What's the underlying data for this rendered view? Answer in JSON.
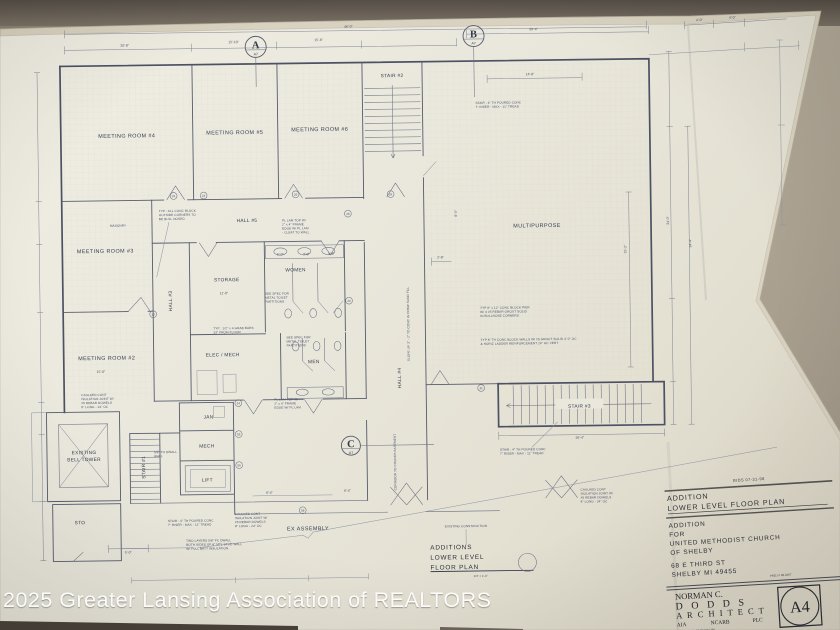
{
  "watermark": "2025 Greater Lansing Association of REALTORS",
  "plan": {
    "rooms": {
      "mr4": "MEETING ROOM #4",
      "mr5": "MEETING ROOM #5",
      "mr6": "MEETING ROOM #6",
      "mr3": "MEETING ROOM #3",
      "mr2": "MEETING ROOM #2",
      "hall5": "HALL #5",
      "hall4": "HALL #4",
      "hall3": "HALL #3",
      "multipurpose": "MULTIPURPOSE",
      "stair1": "STAIR #1",
      "stair2": "STAIR #2",
      "stair3": "STAIR #3",
      "storage": "STORAGE",
      "women": "WOMEN",
      "men": "MEN",
      "elec_mech": "ELEC / MECH",
      "jan": "JAN",
      "mech": "MECH",
      "lift": "LIFT",
      "bell1": "EXISTING",
      "bell2": "BELL TOWER",
      "sto": "STO"
    },
    "markers": {
      "a": "A",
      "b": "B",
      "c": "C",
      "sub": "A7"
    },
    "dims": [
      "20'-8\"",
      "15'-10\"",
      "15'-6\"",
      "46'-0\"",
      "39'-4\"",
      "14'-8\"",
      "4'-0\"",
      "4'-0\"",
      "2'-8\"",
      "31'-2\"",
      "34'-0\"",
      "34'-4\"",
      "26'-4\"",
      "5'-0\"",
      "6'-4\"",
      "6'-4\"",
      "8'-0\"",
      "5'-0\"",
      "3'-0\"",
      "3'-0\"",
      "11'-0\"",
      "15'-0\""
    ],
    "tags": [
      "23",
      "24",
      "25",
      "26",
      "28",
      "29",
      "33",
      "54",
      "55",
      "56",
      "58",
      "21"
    ],
    "notes": {
      "bullnose": [
        "TYP : ALL CONC BLOCK",
        "OUTSIDE CORNERS TO",
        "BE BULL NOSED"
      ],
      "pier": [
        "TYP 8\" x 12\" CONC BLOCK PIER",
        "W/ 4 #5 REBAR GROUT SOLID",
        "IN BULLNOSE CORNERS"
      ],
      "block_walls": [
        "TYP 8\" TH CONC BLOCK WALLS W/ #5 GROUT SOLID 4'-0\" OC",
        "& HORIZ LADDER REINFORCEMENT 24\" OC VERT"
      ],
      "stair_conc": [
        "STAIR : 4\" TH POURED CONC",
        "7\" RISER - MAX - 11\" TREAD"
      ],
      "caulked": [
        "CAULKED CONT",
        "ISOLATION JOINT W/",
        "#5 REBAR DOWELS",
        "8\" LONG - 24\" OC"
      ],
      "grab_bars": [
        "TYP : 1/2\" x 4 GRAB BARS",
        "33\" FROM FLOOR"
      ],
      "partitions": [
        "SEE SPEC FOR",
        "METAL TOILET",
        "PARTITIONS"
      ],
      "plam_top": [
        "PL LAM TOP W/",
        "2\" x 4\" FRAME",
        "EDGE W/ PL LAM",
        "- CLEAT TO WALL"
      ],
      "dwall": [
        "5/8\" TH DWALL",
        "WALL"
      ],
      "two_layers": [
        "TWO LAYERS 5/8\" FC DWALL",
        "BOTH SIDES OF 6\" MTL STUD WALL",
        "W/ FULL BATT INSULATION"
      ],
      "slope": "SLOPE UP 3\" - 2\" TO CONC IN COMP SAND FILL",
      "masonry": "MASONRY",
      "existing_construction": "EXISTING CONSTRUCTION",
      "corridor": "CORRIDOR TO CHURCH BASEMENT",
      "ex_assembly": "EX ASSEMBLY"
    },
    "title": {
      "line1": "ADDITIONS",
      "line2": "LOWER LEVEL",
      "line3": "FLOOR PLAN",
      "scale": "1/4\" = 1'-0\""
    }
  },
  "title_block": {
    "date": "BIDS  07-31-98",
    "addition": "ADDITION",
    "sheet_title": "LOWER LEVEL FLOOR PLAN",
    "addition2": "ADDITION",
    "for_label": "FOR",
    "client1": "UNITED METHODIST CHURCH",
    "client2": "OF SHELBY",
    "address1": "68 E THIRD ST",
    "address2": "SHELBY  MI  49455",
    "proj": "PROJ # 98-0457",
    "arch1": "NORMAN C.",
    "arch2": "D O D D S",
    "arch3": "A R C H I T E C T",
    "cred1": "AIA",
    "cred2": "NCARB",
    "cred3": "PLC",
    "addr_small1": "141 HANCOCK ST      PO BOX 364",
    "addr_small2": "PENTWATER   MICHIGAN   49449",
    "sheet_no": "A4"
  }
}
